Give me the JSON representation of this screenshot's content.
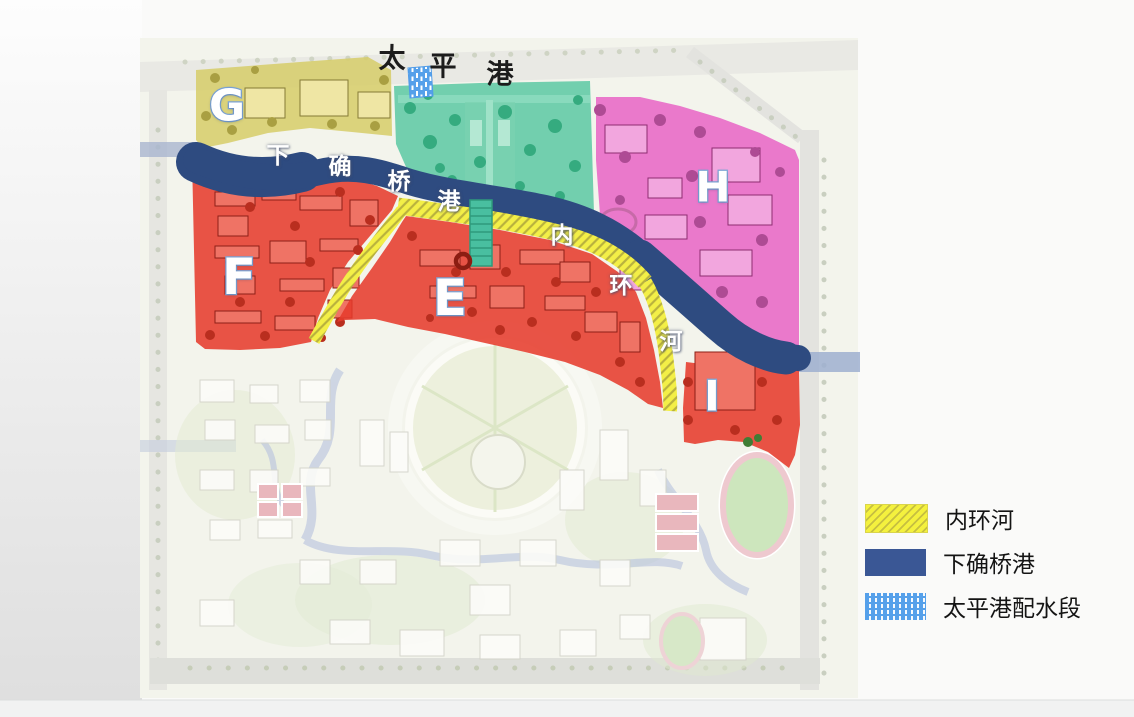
{
  "slide": {
    "top_label": {
      "name": "taiping-gang-waterway",
      "chars": [
        "太",
        "平",
        "港"
      ]
    },
    "map": {
      "river_label": {
        "name": "xiaqueqiao-gang-river",
        "chars": [
          "下",
          "确",
          "桥",
          "港"
        ]
      },
      "ring_label": {
        "name": "inner-ring-river",
        "chars": [
          "内",
          "环",
          "河"
        ]
      },
      "zones": [
        {
          "id": "G",
          "label": "G",
          "color": "#d6cd69"
        },
        {
          "id": "F",
          "label": "F",
          "color": "#e63b2c"
        },
        {
          "id": "E",
          "label": "E",
          "color": "#e63b2c"
        },
        {
          "id": "H",
          "label": "H",
          "color": "#e763c6"
        },
        {
          "id": "I",
          "label": "I",
          "color": "#e63b2c"
        }
      ],
      "park_zone_color": "#5ac8a3",
      "river_color": "#2e4b80",
      "inner_ring_color": "#f2ee3e"
    },
    "legend": {
      "items": [
        {
          "label": "内环河",
          "swatch": "yellow-hatch",
          "color": "#f2ee3e"
        },
        {
          "label": "下确桥港",
          "swatch": "navy-solid",
          "color": "#3a5795"
        },
        {
          "label": "太平港配水段",
          "swatch": "blue-dash",
          "color": "#55a0ea"
        }
      ]
    }
  }
}
